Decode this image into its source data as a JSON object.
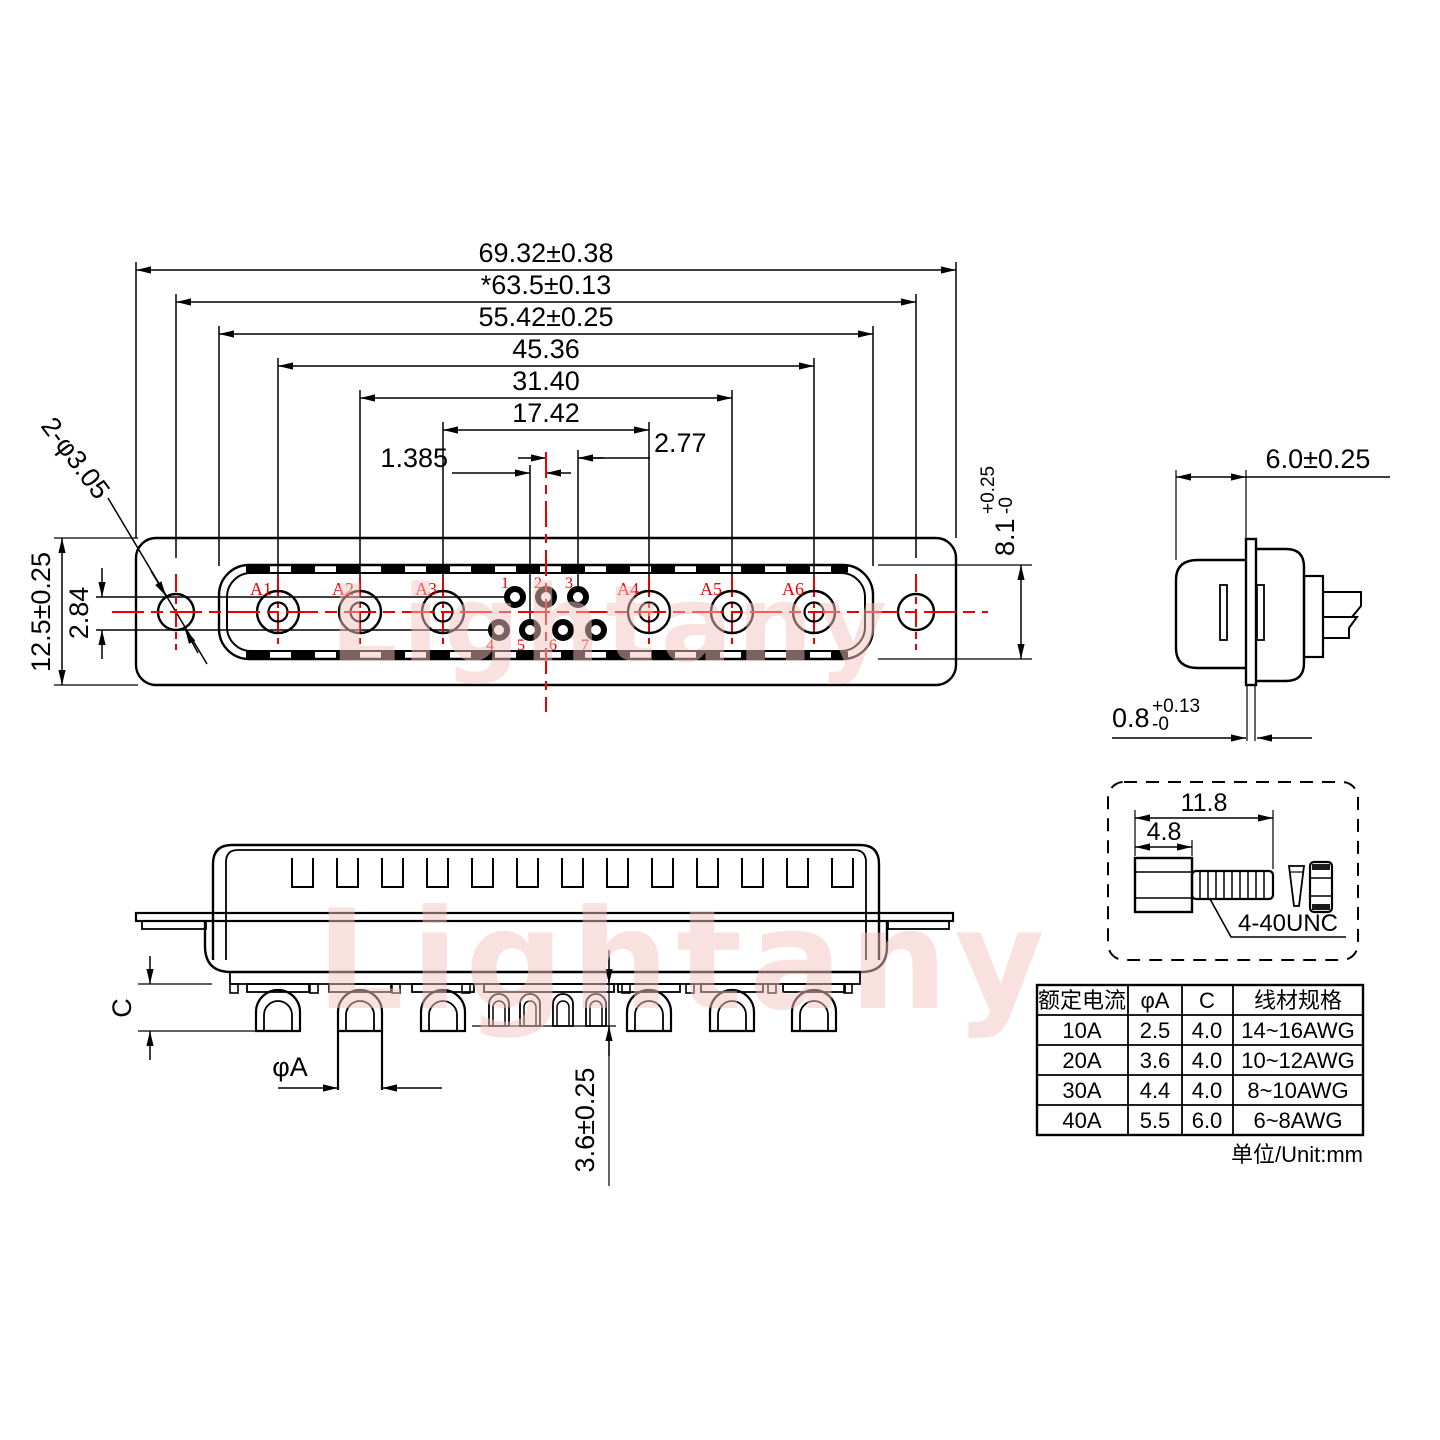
{
  "front_view": {
    "dims_top": [
      "69.32±0.38",
      "*63.5±0.13",
      "55.42±0.25",
      "45.36",
      "31.40",
      "17.42"
    ],
    "dim_pin_pitch": "2.77",
    "dim_pin_half_pitch": "1.385",
    "dim_flange_height": "12.5±0.25",
    "dim_row_spacing": "2.84",
    "dim_mounting_holes": "2-φ3.05",
    "dim_shell_height": {
      "value": "8.1",
      "tol_plus": "+0.25",
      "tol_minus": "-0"
    },
    "power_contacts": [
      "A1",
      "A2",
      "A3",
      "A4",
      "A5",
      "A6"
    ],
    "signal_pins": [
      "1",
      "2",
      "3",
      "4",
      "5",
      "6",
      "7"
    ]
  },
  "side_view": {
    "dim_shell_depth": "6.0±0.25",
    "dim_flange_thickness": {
      "value": "0.8",
      "tol_plus": "+0.13",
      "tol_minus": "-0"
    }
  },
  "bottom_view": {
    "dim_solder_cup_depth": "C",
    "dim_pin_diameter": "φA",
    "dim_signal_cup": "3.6±0.25"
  },
  "screw_detail": {
    "dim_total_length": "11.8",
    "dim_head_length": "4.8",
    "thread_spec": "4-40UNC"
  },
  "spec_table": {
    "headers": [
      "额定电流",
      "φA",
      "C",
      "线材规格"
    ],
    "rows": [
      [
        "10A",
        "2.5",
        "4.0",
        "14~16AWG"
      ],
      [
        "20A",
        "3.6",
        "4.0",
        "10~12AWG"
      ],
      [
        "30A",
        "4.4",
        "4.0",
        "8~10AWG"
      ],
      [
        "40A",
        "5.5",
        "6.0",
        "6~8AWG"
      ]
    ],
    "unit_note": "单位/Unit:mm"
  },
  "watermark": {
    "text": "Lightany"
  },
  "colors": {
    "line": "#000000",
    "accent_red": "#ee0000",
    "watermark_pink": "#f3c4bf",
    "background": "#ffffff"
  }
}
